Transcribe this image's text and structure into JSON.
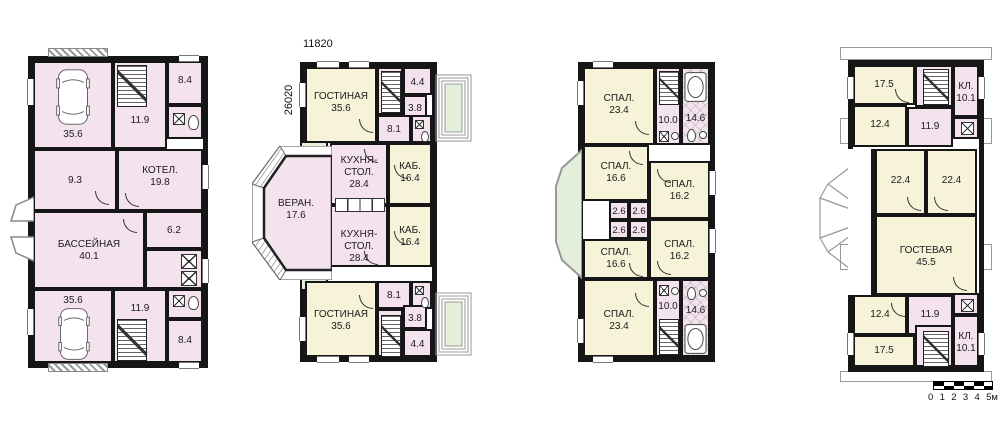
{
  "colors": {
    "wall": "#161616",
    "room_pink": "#f4e3ee",
    "room_yellow": "#f6f3d9",
    "terrace_green": "#e3eedb"
  },
  "plans": [
    {
      "name": "basement-garage-floor",
      "rooms": [
        {
          "area": "35.6"
        },
        {
          "area": "8.4"
        },
        {
          "area": "11.9"
        },
        {
          "area": "9.3"
        },
        {
          "label": "КОТЕЛ.",
          "area": "19.8"
        },
        {
          "label": "БАССЕЙНАЯ",
          "area": "40.1"
        },
        {
          "area": "6.2"
        },
        {
          "area": "35.6"
        },
        {
          "area": "11.9"
        },
        {
          "area": "8.4"
        }
      ]
    },
    {
      "name": "ground-floor",
      "dim_width": "11820",
      "dim_height": "26020",
      "rooms": [
        {
          "label": "ГОСТИНАЯ",
          "area": "35.6"
        },
        {
          "area": "4.4"
        },
        {
          "area": "3.8"
        },
        {
          "area": "8.1"
        },
        {
          "label": "КУХНЯ-СТОЛ.",
          "area": "28.4"
        },
        {
          "label": "КАБ.",
          "area": "16.4"
        },
        {
          "label": "ВЕРАН.",
          "area": "17.6"
        },
        {
          "label": "КУХНЯ-СТОЛ.",
          "area": "28.4"
        },
        {
          "label": "КАБ.",
          "area": "16.4"
        },
        {
          "area": "8.1"
        },
        {
          "area": "3.8"
        },
        {
          "area": "4.4"
        },
        {
          "label": "ГОСТИНАЯ",
          "area": "35.6"
        }
      ]
    },
    {
      "name": "bedroom-floor",
      "rooms": [
        {
          "label": "СПАЛ.",
          "area": "23.4"
        },
        {
          "area": "10.0"
        },
        {
          "area": "14.6"
        },
        {
          "label": "СПАЛ.",
          "area": "16.6"
        },
        {
          "label": "СПАЛ.",
          "area": "16.2"
        },
        {
          "area": "2.6"
        },
        {
          "area": "2.6"
        },
        {
          "area": "2.6"
        },
        {
          "area": "2.6"
        },
        {
          "label": "СПАЛ.",
          "area": "16.6"
        },
        {
          "label": "СПАЛ.",
          "area": "16.2"
        },
        {
          "area": "10.0"
        },
        {
          "label": "СПАЛ.",
          "area": "23.4"
        },
        {
          "area": "14.6"
        }
      ]
    },
    {
      "name": "attic-floor",
      "rooms": [
        {
          "area": "17.5"
        },
        {
          "label": "КЛ.",
          "area": "10.1"
        },
        {
          "area": "12.4"
        },
        {
          "area": "11.9"
        },
        {
          "area": "22.4"
        },
        {
          "area": "22.4"
        },
        {
          "label": "ГОСТЕВАЯ",
          "area": "45.5"
        },
        {
          "area": "12.4"
        },
        {
          "area": "11.9"
        },
        {
          "area": "17.5"
        },
        {
          "label": "КЛ.",
          "area": "10.1"
        }
      ]
    }
  ],
  "scale_bar": {
    "ticks": [
      "0",
      "1",
      "2",
      "3",
      "4",
      "5м"
    ]
  }
}
